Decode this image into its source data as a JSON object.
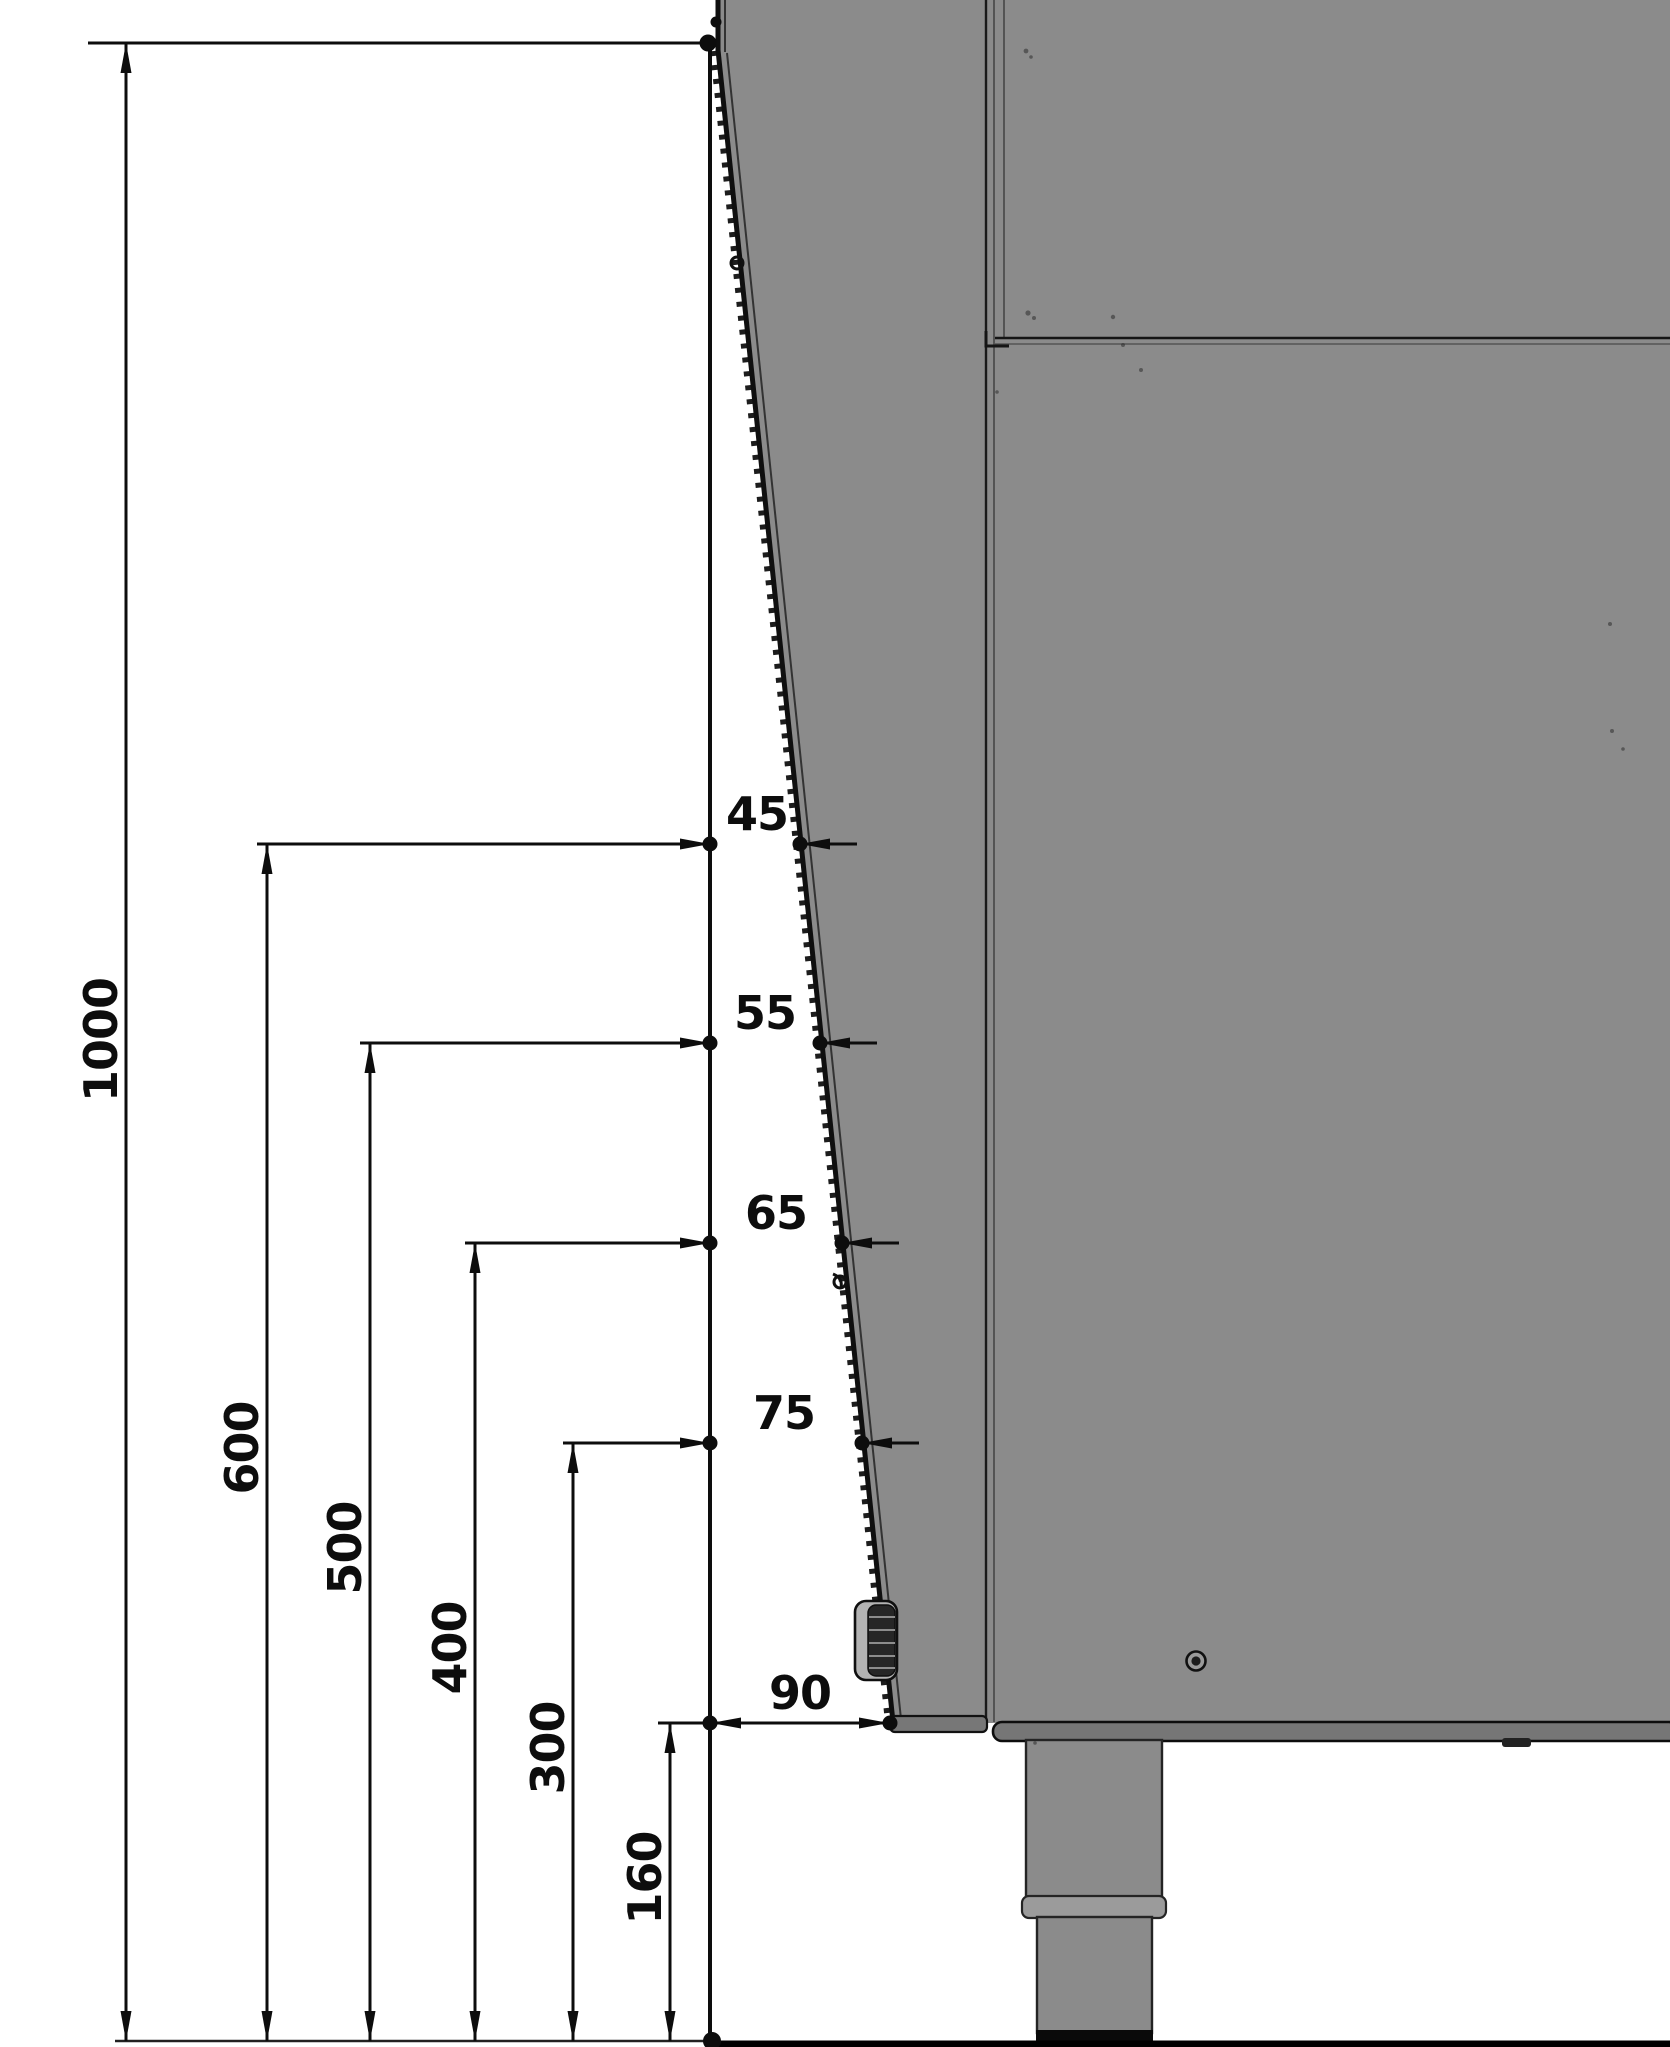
{
  "drawing": {
    "kind": "orthographic side-view dimension drawing",
    "machine_color": "#8b8b8b",
    "line_color": "#111111",
    "overall_height_label": "1000"
  },
  "dims": {
    "vertical": [
      {
        "label": "1000"
      },
      {
        "label": "600"
      },
      {
        "label": "500"
      },
      {
        "label": "400"
      },
      {
        "label": "300"
      },
      {
        "label": "160"
      }
    ],
    "horizontal": [
      {
        "label": "45"
      },
      {
        "label": "55"
      },
      {
        "label": "65"
      },
      {
        "label": "75"
      },
      {
        "label": "90"
      }
    ],
    "pairs": [
      {
        "height": "600",
        "offset": "45"
      },
      {
        "height": "500",
        "offset": "55"
      },
      {
        "height": "400",
        "offset": "65"
      },
      {
        "height": "300",
        "offset": "75"
      },
      {
        "height": "160",
        "offset": "90"
      }
    ]
  }
}
